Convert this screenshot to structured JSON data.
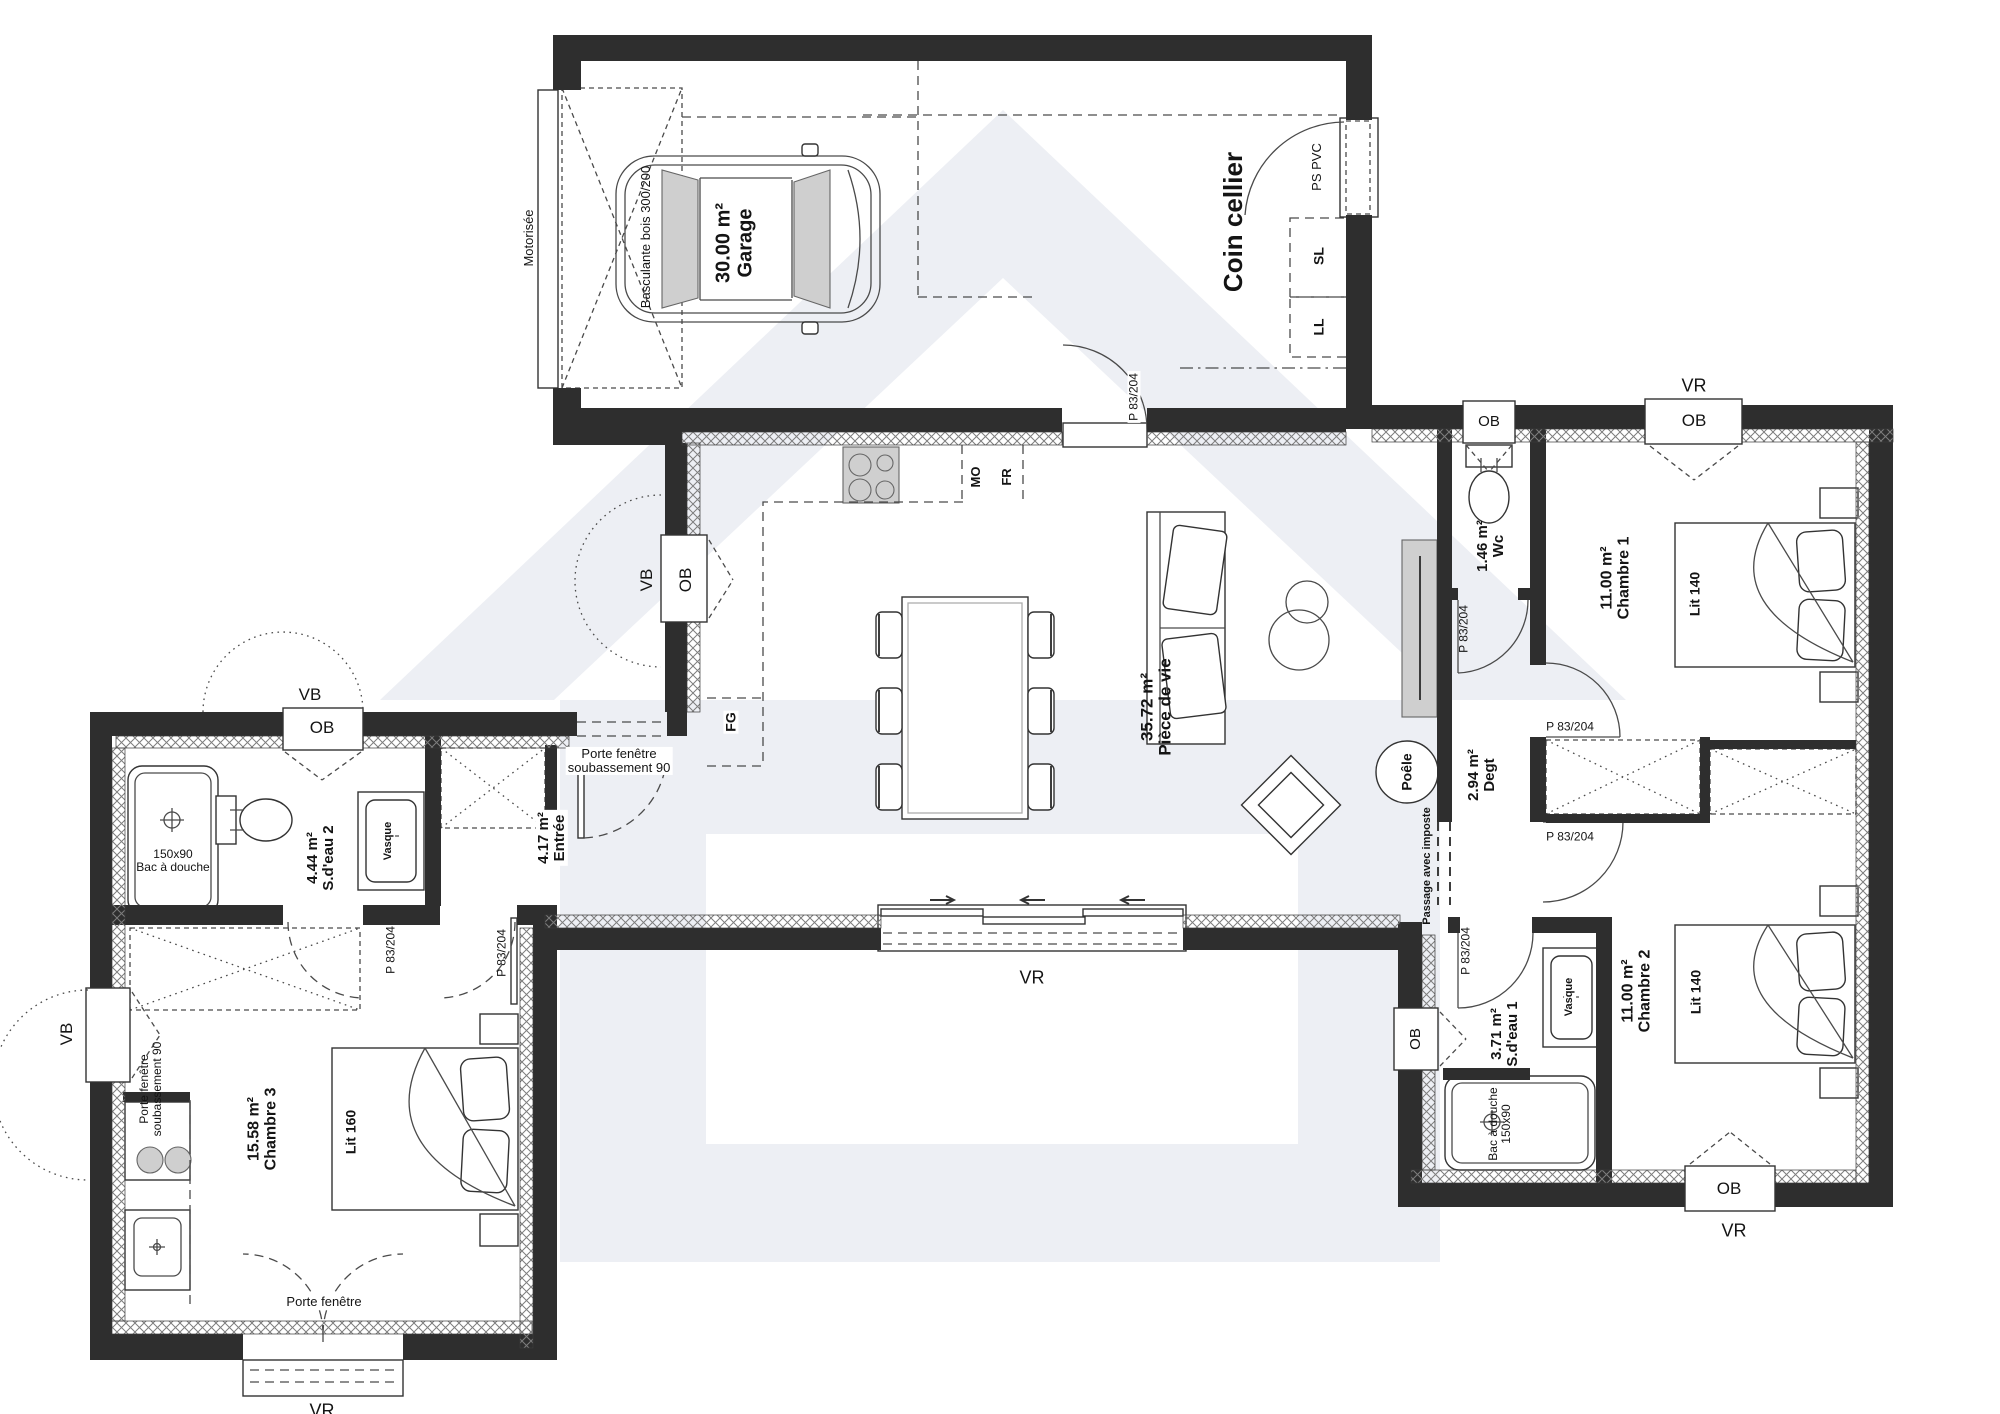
{
  "plan": {
    "rooms": {
      "garage": {
        "area": "30.00 m²",
        "name": "Garage"
      },
      "cellier": {
        "name": "Coin cellier"
      },
      "piece_de_vie": {
        "area": "35.72 m²",
        "name": "Pièce de vie"
      },
      "wc": {
        "area": "1.46 m²",
        "name": "Wc"
      },
      "degt": {
        "area": "2.94 m²",
        "name": "Degt"
      },
      "chambre1": {
        "area": "11.00 m²",
        "name": "Chambre 1",
        "bed": "Lit 140"
      },
      "chambre2": {
        "area": "11.00 m²",
        "name": "Chambre 2",
        "bed": "Lit 140"
      },
      "chambre3": {
        "area": "15.58 m²",
        "name": "Chambre 3",
        "bed": "Lit 160"
      },
      "sdeau1": {
        "area": "3.71 m²",
        "name": "S.d'eau 1"
      },
      "sdeau2": {
        "area": "4.44 m²",
        "name": "S.d'eau 2"
      },
      "entree": {
        "area": "4.17 m²",
        "name": "Entrée"
      }
    },
    "labels": {
      "motorisee": "Motorisée",
      "basculante": "Basculante bois 300/200",
      "ps_pvc": "PS PVC",
      "sl": "SL",
      "ll": "LL",
      "mo": "MO",
      "fr": "FR",
      "fg": "FG",
      "poele": "Poêle",
      "passage": "Passage avec imposte",
      "porte_fenetre": "Porte fenêtre",
      "soubassement": "soubassement 90",
      "vasque": "Vasque",
      "bac": "Bac à douche",
      "size_150x90": "150x90",
      "p83": "P 83/204",
      "vr": "VR",
      "vb": "VB",
      "ob": "OB"
    }
  }
}
